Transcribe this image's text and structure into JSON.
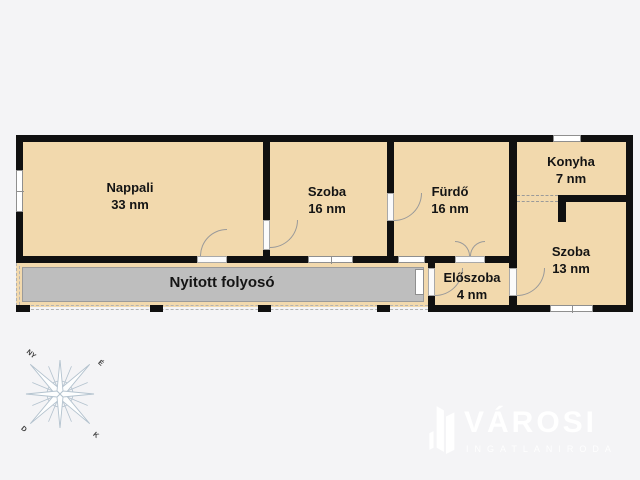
{
  "colors": {
    "background": "#f4f4f6",
    "wall": "#101010",
    "room_fill": "#f2d9ad",
    "corridor_fill": "#bebebe",
    "compass_line": "#b3c2ce",
    "logo_white": "#ffffff"
  },
  "rooms": [
    {
      "label": "Nappali",
      "area": "33 nm"
    },
    {
      "label": "Szoba",
      "area": "16 nm"
    },
    {
      "label": "Fürdő",
      "area": "16 nm"
    },
    {
      "label": "Konyha",
      "area": "7 nm"
    },
    {
      "label": "Szoba",
      "area": "13 nm"
    },
    {
      "label": "Előszoba",
      "area": "4 nm"
    }
  ],
  "corridor": {
    "label": "Nyitott folyosó"
  },
  "compass": {
    "west": "NY",
    "north": "É",
    "south": "D",
    "east": "K"
  },
  "logo": {
    "title": "VÁROSI",
    "subtitle": "INGATLANIRODA"
  }
}
